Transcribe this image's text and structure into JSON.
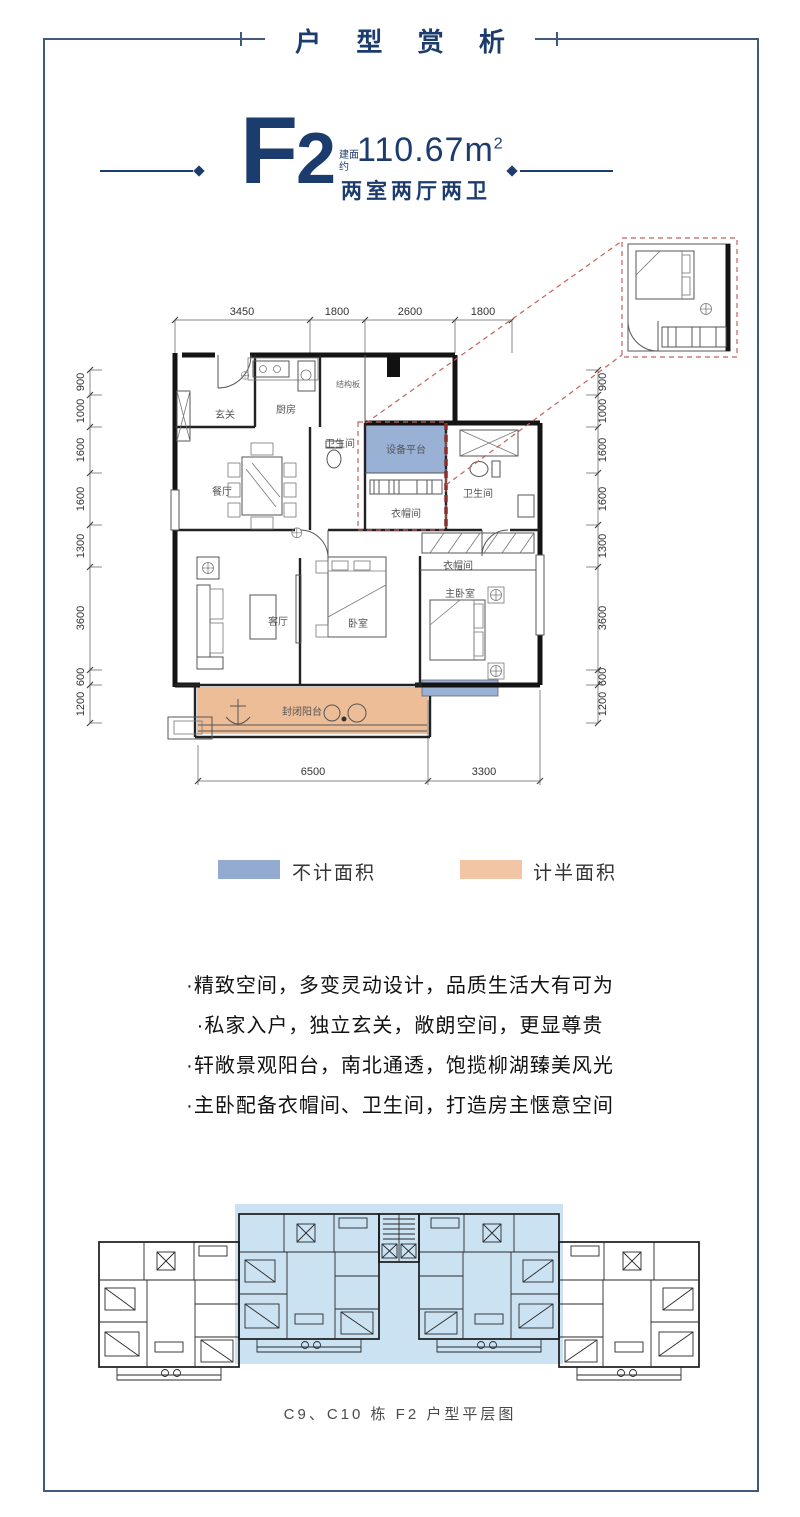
{
  "page": {
    "title": "户 型 赏 析",
    "caption": "C9、C10 栋 F2 户型平层图",
    "frame_color": "#41597a"
  },
  "unit": {
    "name_letter": "F",
    "name_digit": "2",
    "area_label_line1": "建面",
    "area_label_line2": "约",
    "area_value": "110.67",
    "area_unit": "m",
    "area_exponent": "2",
    "layout": "两室两厅两卫",
    "accent_color": "#1d3c6e"
  },
  "legend": {
    "no_count_label": "不计面积",
    "no_count_color": "#93aad1",
    "half_count_label": "计半面积",
    "half_count_color": "#f2c6a4"
  },
  "features": {
    "items": [
      "·精致空间，多变灵动设计，品质生活大有可为",
      "·私家入户，独立玄关，敞朗空间，更显尊贵",
      "·轩敞景观阳台，南北通透，饱揽柳湖臻美风光",
      "·主卧配备衣帽间、卫生间，打造房主惬意空间"
    ]
  },
  "floor_plan": {
    "rooms": {
      "entry": "玄关",
      "kitchen": "厨房",
      "structure_board": "结构板",
      "bathroom_mid": "卫生间",
      "dining": "餐厅",
      "equipment_platform": "设备平台",
      "cloakroom_mid": "衣帽间",
      "bathroom_right": "卫生间",
      "cloakroom_master": "衣帽间",
      "living": "客厅",
      "bedroom": "卧室",
      "master_bedroom": "主卧室",
      "balcony": "封闭阳台"
    },
    "dims_top": [
      "3450",
      "1800",
      "2600",
      "1800"
    ],
    "dims_left": [
      "900",
      "1000",
      "1600",
      "1600",
      "1300",
      "3600",
      "600",
      "1200"
    ],
    "dims_right": [
      "900",
      "1000",
      "1600",
      "1600",
      "1300",
      "3600",
      "600",
      "1200"
    ],
    "dims_bottom": [
      "6500",
      "3300"
    ],
    "zone_colors": {
      "no_count": "#9ab1d6",
      "half_count": "#edbd97"
    }
  }
}
